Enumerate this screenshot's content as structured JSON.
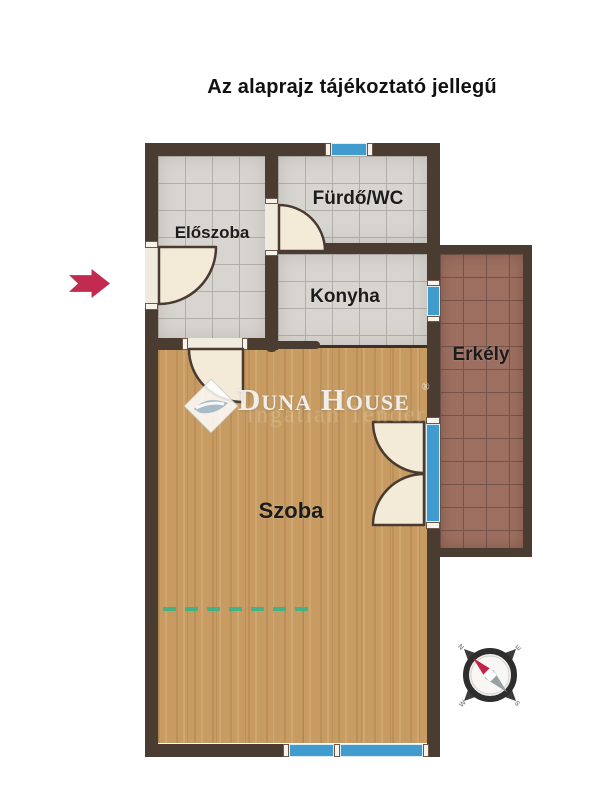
{
  "title": "Az alaprajz tájékoztató jellegű",
  "rooms": {
    "eloszoba": "Előszoba",
    "furdo_wc": "Fürdő/WC",
    "konyha": "Konyha",
    "szoba": "Szoba",
    "erkely": "Erkély"
  },
  "watermark": {
    "brand": "Duna House",
    "registered": "®",
    "sub_text": "Ingatlan Tender"
  },
  "compass": {
    "n": "N",
    "e": "E",
    "s": "S",
    "w": "W"
  },
  "colors": {
    "wall": "#4b3c32",
    "tile_base": "#d8d5d0",
    "tile_grid": "#b2afa9",
    "wood_base": "#c79b61",
    "balcony_base": "#9d6f60",
    "balcony_grout": "#74544a",
    "window_blue": "#419bcd",
    "door_cream": "#f3ead8",
    "door_outline": "#4a3b31",
    "arrow_red": "#c22a50",
    "dash_teal": "#35b48b",
    "title_color": "#111111",
    "label_color": "#1c1c1c",
    "watermark_white": "rgba(250,250,250,0.88)",
    "compass_dark": "#333333",
    "compass_red": "#c0244a",
    "compass_gray": "#9aa0a0"
  }
}
